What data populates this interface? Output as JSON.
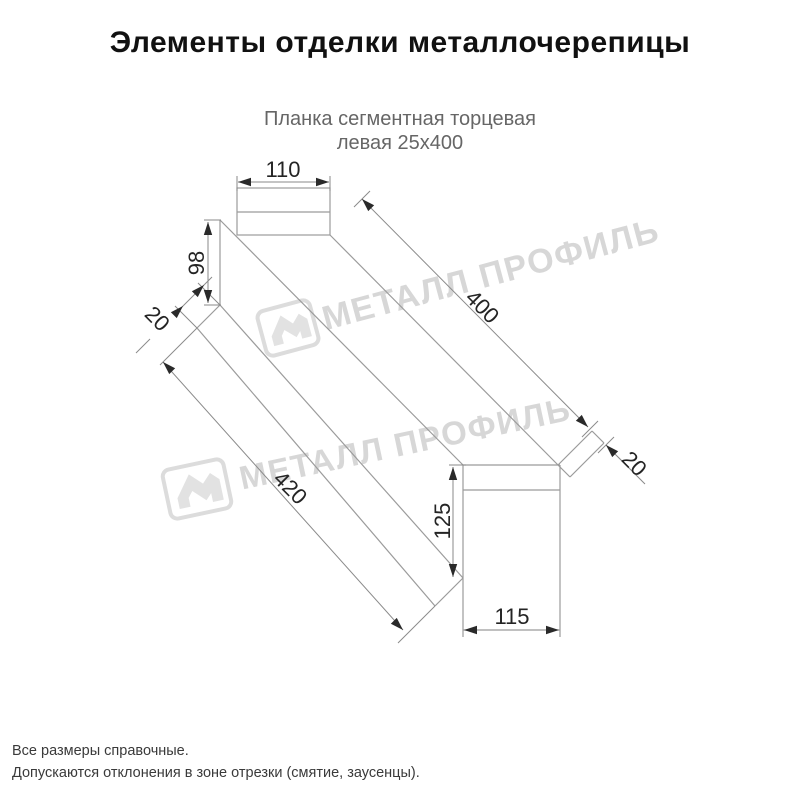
{
  "header": {
    "title": "Элементы отделки металлочерепицы"
  },
  "subtitle": {
    "line1": "Планка сегментная торцевая",
    "line2": "левая 25х400"
  },
  "watermark": {
    "text": "МЕТАЛЛ ПРОФИЛЬ",
    "color": "#d7d7d7",
    "logo": "metal-profil-logo"
  },
  "diagram": {
    "type": "technical-drawing",
    "part_labels": {
      "top_width": "110",
      "end_height": "98",
      "hem_left": "20",
      "length": "400",
      "total_length": "420",
      "face_height": "125",
      "base_width": "115",
      "hem_right": "20"
    }
  },
  "footer": {
    "line1": "Все размеры справочные.",
    "line2": "Допускаются отклонения в зоне отрезки (смятие, заусенцы)."
  },
  "colors": {
    "background": "#ffffff",
    "line": "#9b9b9b",
    "dimension_line": "#8a8a8a",
    "label": "#242424",
    "title": "#111111",
    "subtitle": "#666666",
    "watermark": "#d7d7d7"
  }
}
